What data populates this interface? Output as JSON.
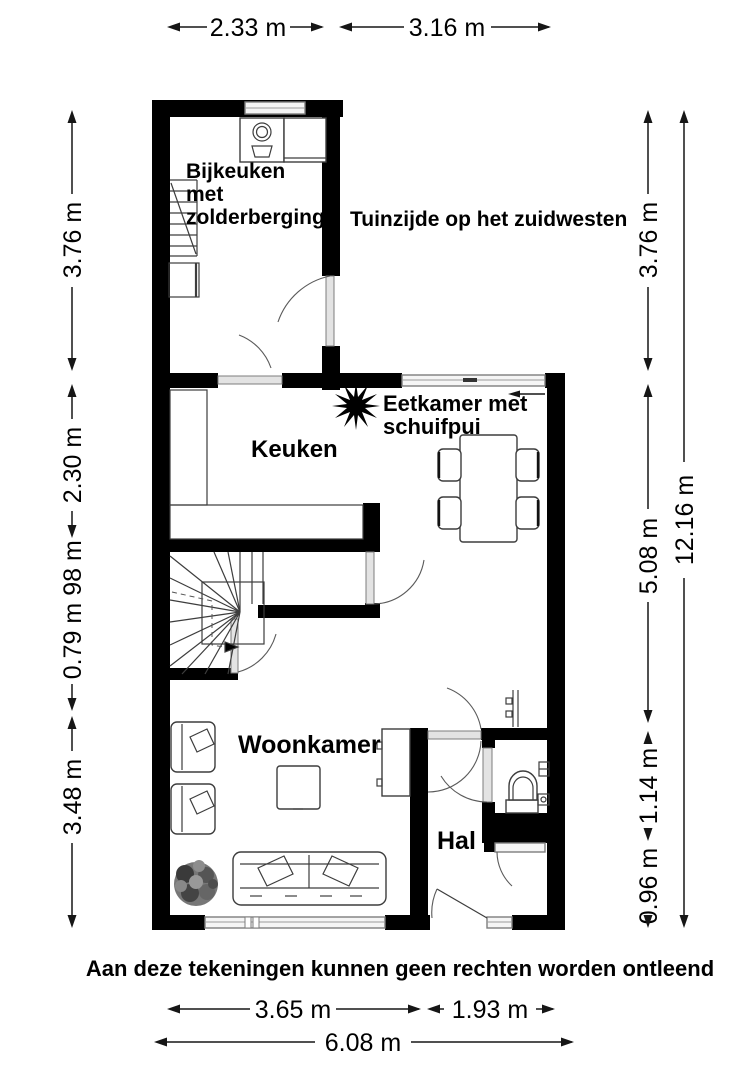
{
  "plan_labels": {
    "bijkeuken": [
      "Bijkeuken",
      "met",
      "zolderberging"
    ],
    "garden_side": "Tuinzijde op het zuidwesten",
    "keuken": "Keuken",
    "eetkamer": [
      "Eetkamer met",
      "schuifpui"
    ],
    "woonkamer": "Woonkamer",
    "hal": "Hal"
  },
  "dimensions": {
    "top": [
      "2.33 m",
      "3.16 m"
    ],
    "left": [
      "3.76 m",
      "2.30 m",
      "98 m",
      "0.79 m",
      "3.48 m"
    ],
    "right": [
      "3.76 m",
      "5.08 m",
      "1.14 m",
      "0.96 m"
    ],
    "right_total": "12.16 m",
    "bottom": [
      "3.65 m",
      "1.93 m"
    ],
    "bottom_total": "6.08 m"
  },
  "disclaimer": "Aan deze tekeningen kunnen geen rechten worden ontleend",
  "colors": {
    "wall": "#000000",
    "background": "#ffffff",
    "glazing": "#f5f5f5",
    "line": "#3d3d3d"
  },
  "icons": {
    "plant_dining": "black-starburst-plant",
    "plant_living": "speckled-bush",
    "washing_machine": "square-with-drum-circle",
    "toilet": "arched-bowl-with-cistern",
    "stairs_winder": "fan-tread-stairs-with-arrow",
    "stairs_straight": "parallel-tread-stairs"
  }
}
